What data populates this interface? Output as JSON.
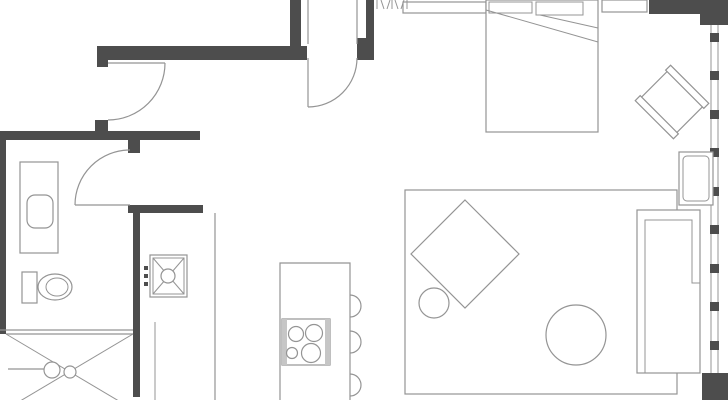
{
  "plan": {
    "type": "apartment-floor-plan",
    "colors": {
      "paper": "#ffffff",
      "wall": "#4d4d4d",
      "line": "#949494",
      "rail": "#c6c6c6"
    },
    "rooms": [
      "entry-hall",
      "bathroom",
      "kitchen",
      "living-area",
      "sleeping-area"
    ],
    "doors": [
      {
        "name": "hall-door",
        "swing": "quarter-arc"
      },
      {
        "name": "entry-door",
        "swing": "quarter-arc"
      },
      {
        "name": "bathroom-door",
        "swing": "quarter-arc"
      }
    ],
    "fixtures": [
      "vanity-counter",
      "wash-basin",
      "toilet",
      "shower-tray",
      "shower-head",
      "kitchen-sink",
      "kitchen-counter",
      "kitchen-island",
      "cooktop-4-burners",
      "bar-stools-x3",
      "wardrobe-hangers",
      "dresser",
      "bed",
      "pillows-x2",
      "nightstand",
      "armchair-rotated",
      "side-table",
      "sofa-l-shaped",
      "rug",
      "square-table-rotated",
      "ottoman",
      "round-coffee-table",
      "window-curtain-wall"
    ],
    "window": {
      "mullion_ticks": 9
    }
  }
}
